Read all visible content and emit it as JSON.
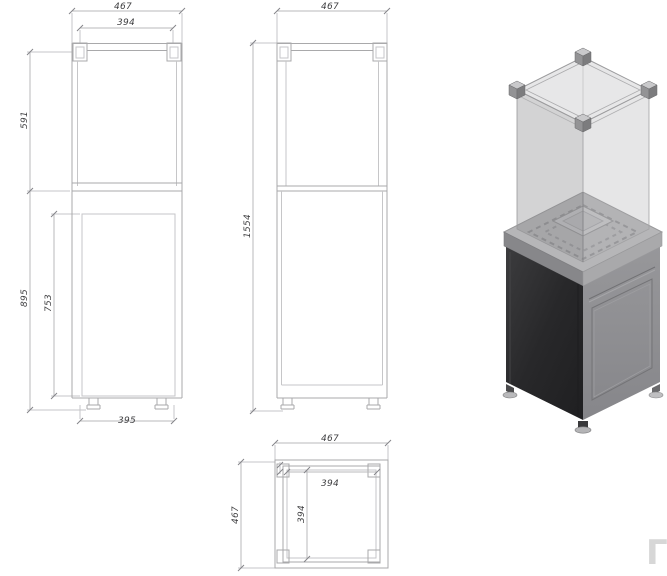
{
  "drawing": {
    "front_view": {
      "dimensions": {
        "overall_width": "467",
        "glass_frame_width": "394",
        "glass_section_height": "591",
        "body_height": "895",
        "door_height": "753",
        "base_width": "395"
      }
    },
    "side_view": {
      "dimensions": {
        "overall_depth": "467",
        "overall_height": "1554"
      }
    },
    "plan_view": {
      "dimensions": {
        "overall_width": "467",
        "overall_depth": "467",
        "inner_width": "394",
        "inner_depth": "394"
      }
    }
  },
  "watermark": {
    "glyph": "Γ"
  },
  "colors": {
    "line": "#a9a9ab",
    "dim_text": "#3f3f41",
    "cabinet_dark_face": "#2c2c2e",
    "cabinet_light_face": "#8e8e90",
    "collar": "#b6b6b8",
    "glass_tint": "#a9a9ab",
    "background": "#ffffff"
  }
}
